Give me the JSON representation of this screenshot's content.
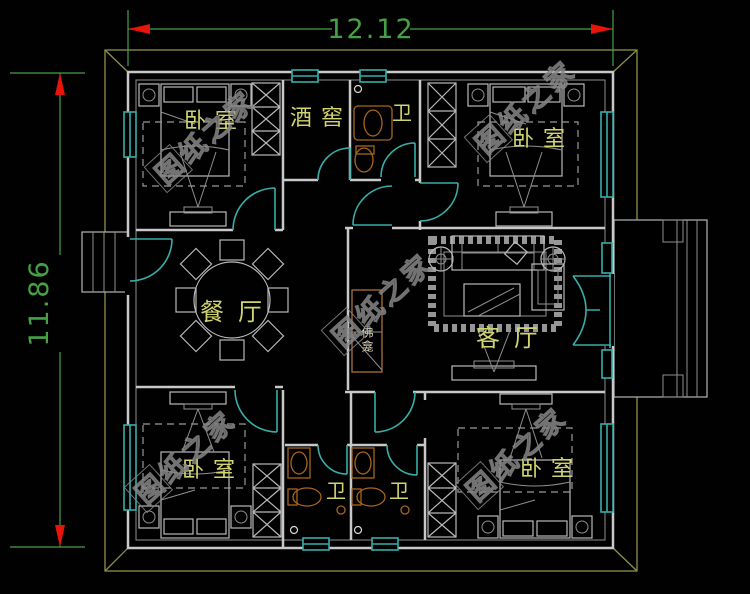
{
  "dimensions": {
    "width_label": "12.12",
    "height_label": "11.86"
  },
  "rooms": {
    "bedroom_top_left": "卧室",
    "bedroom_top_right": "卧室",
    "bedroom_bottom_left": "卧室",
    "bedroom_bottom_right": "卧室",
    "wine_cellar": "酒窖",
    "bathroom_top": "卫",
    "bathroom_bottom_left": "卫",
    "bathroom_bottom_right": "卫",
    "dining_room": "餐厅",
    "living_room": "客厅",
    "shrine": "佛龛"
  },
  "watermark": {
    "text": "图纸之家"
  },
  "colors": {
    "background": "#010101",
    "wall": "#c8c8c8",
    "door_window": "#38aea8",
    "dimension": "#46a046",
    "dimension_arrow": "#e81309",
    "roof_outline": "#8f8f4a",
    "room_label": "#d2d470",
    "fixture": "#a8651d",
    "watermark": "#878787"
  }
}
